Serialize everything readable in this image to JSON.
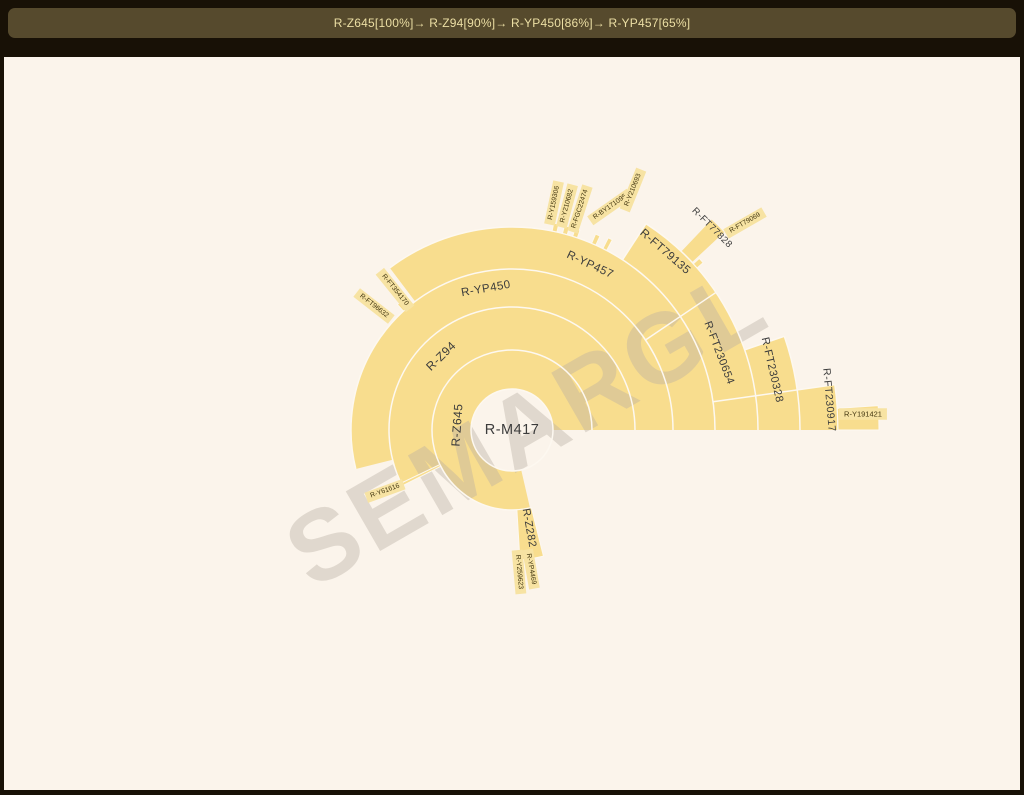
{
  "header": {
    "breadcrumb": [
      {
        "label": "R-Z645",
        "pct": "100%"
      },
      {
        "label": "R-Z94",
        "pct": "90%"
      },
      {
        "label": "R-YP450",
        "pct": "86%"
      },
      {
        "label": "R-YP457",
        "pct": "65%"
      }
    ],
    "separator": "→ "
  },
  "watermark": "SEMARGL",
  "colors": {
    "page_bg": "#181106",
    "bar_bg": "#564a2d",
    "bar_text": "#ecdfa4",
    "canvas_bg": "#fbf4eb",
    "wedge_fill": "#f8dd8e",
    "stub_box_fill": "#f7e3a3",
    "separator_stroke": "#fdf8f0",
    "label_text": "#3c3c3c",
    "stub_text": "#41350f",
    "watermark_color": "rgba(184,174,162,0.40)"
  },
  "chart_data": {
    "type": "sunburst",
    "title": "Y-DNA haplogroup subclade tree (radial sunburst)",
    "center_label": "R-M417",
    "legend_position": "none",
    "grid": false,
    "nodes": [
      {
        "name": "R-M417",
        "parent": null,
        "depth": 0
      },
      {
        "name": "R-Z645",
        "parent": "R-M417",
        "depth": 1,
        "span_deg": [
          0,
          283
        ]
      },
      {
        "name": "R-Z94",
        "parent": "R-Z645",
        "depth": 2,
        "span_deg": [
          0,
          207
        ]
      },
      {
        "name": "R-Y61616",
        "parent": "R-Z645",
        "depth": 2,
        "span_deg": [
          205.6,
          207
        ]
      },
      {
        "name": "R-Z282",
        "parent": "R-Z645",
        "depth": 2,
        "span_deg": [
          273.5,
          284
        ]
      },
      {
        "name": "R-Y259623",
        "parent": "R-Z282",
        "depth": 3,
        "span_deg": [
          271,
          274
        ]
      },
      {
        "name": "R-YP4469",
        "parent": "R-Z282",
        "depth": 3,
        "span_deg": [
          276,
          279
        ]
      },
      {
        "name": "R-YP450",
        "parent": "R-Z94",
        "depth": 3,
        "span_deg": [
          0,
          194
        ]
      },
      {
        "name": "R-YP457",
        "parent": "R-YP450",
        "depth": 4,
        "span_deg": [
          34,
          127
        ]
      },
      {
        "name": "R-FT354170",
        "parent": "R-YP450",
        "depth": 4,
        "span_deg": [
          128,
          129.4
        ]
      },
      {
        "name": "R-FT96632",
        "parent": "R-YP450",
        "depth": 4,
        "span_deg": [
          131,
          132.4
        ]
      },
      {
        "name": "R-FT230654",
        "parent": "R-YP450",
        "depth": 4,
        "span_deg": [
          0,
          34
        ]
      },
      {
        "name": "R-Y159306",
        "parent": "R-YP457",
        "depth": 5,
        "span_deg": [
          77.2,
          78.6
        ]
      },
      {
        "name": "R-Y210682",
        "parent": "R-YP457",
        "depth": 5,
        "span_deg": [
          74.2,
          75.6
        ]
      },
      {
        "name": "R-FGC22474",
        "parent": "R-YP457",
        "depth": 5,
        "span_deg": [
          71.2,
          72.6
        ]
      },
      {
        "name": "R-BY171095",
        "parent": "R-YP457",
        "depth": 5,
        "span_deg": [
          65.6,
          66.9
        ]
      },
      {
        "name": "R-Y210693",
        "parent": "R-YP457",
        "depth": 5,
        "span_deg": [
          62.2,
          63.4
        ]
      },
      {
        "name": "R-FT79135",
        "parent": "R-YP457",
        "depth": 5,
        "span_deg": [
          34,
          57
        ]
      },
      {
        "name": "R-FT77828",
        "parent": "R-FT79135",
        "depth": 6,
        "span_deg": [
          43,
          46.5
        ]
      },
      {
        "name": "R-FT79069",
        "parent": "R-FT79135",
        "depth": 6,
        "span_deg": [
          41.2,
          42.5
        ]
      },
      {
        "name": "R-FT230328",
        "parent": "R-FT230654",
        "depth": 5,
        "span_deg": [
          2.5,
          19
        ]
      },
      {
        "name": "R-FT230917",
        "parent": "R-FT230328",
        "depth": 6,
        "span_deg": [
          0,
          8
        ]
      },
      {
        "name": "R-Y191421",
        "parent": "R-FT230917",
        "depth": 7,
        "span_deg": [
          0,
          3.8
        ]
      }
    ],
    "geometry": {
      "center_px": {
        "x": 512,
        "y": 430
      },
      "inner_radius": 41,
      "ring_boundaries": [
        41,
        80,
        123,
        161,
        203,
        246,
        288,
        326,
        367
      ],
      "bands": [
        {
          "n": "R-Z645",
          "r0": 41,
          "r1": 80,
          "a0": 0,
          "a1": 283
        },
        {
          "n": "R-Z94",
          "r0": 80,
          "r1": 123,
          "a0": 0,
          "a1": 207
        },
        {
          "n": "R-YP450",
          "r0": 123,
          "r1": 161,
          "a0": 0,
          "a1": 194
        },
        {
          "n": "ring4-R-YP457-R-FT230654",
          "r0": 161,
          "r1": 203,
          "a0": 0,
          "a1": 127
        },
        {
          "n": "ring5-R-FT79135-R-FT230328",
          "r0": 203,
          "r1": 246,
          "a0": 0,
          "a1": 57
        },
        {
          "n": "ring6-R-FT230328-R-FT230917",
          "r0": 246,
          "r1": 288,
          "a0": 0,
          "a1": 19
        },
        {
          "n": "ring7-R-FT230917",
          "r0": 288,
          "r1": 326,
          "a0": 0,
          "a1": 8
        },
        {
          "n": "R-FT77828",
          "r0": 246,
          "r1": 290,
          "a0": 43,
          "a1": 46.5
        }
      ],
      "slivers": [
        {
          "n": "R-Z282",
          "r0": 80,
          "r1": 130,
          "a0": 273.5,
          "a1": 284
        },
        {
          "n": "R-Y191421",
          "r0": 326,
          "r1": 367,
          "a0": 0,
          "a1": 3.8
        },
        {
          "n": "R-Y61616",
          "r0": 80,
          "r1": 123,
          "a0": 205.6,
          "a1": 207
        },
        {
          "n": "R-FT354170",
          "r0": 161,
          "r1": 170,
          "a0": 128,
          "a1": 129.4
        },
        {
          "n": "R-FT96632",
          "r0": 161,
          "r1": 170,
          "a0": 131,
          "a1": 132.4
        },
        {
          "n": "R-Y159306",
          "r0": 203,
          "r1": 211,
          "a0": 77.2,
          "a1": 78.6
        },
        {
          "n": "R-Y210682",
          "r0": 203,
          "r1": 211,
          "a0": 74.2,
          "a1": 75.6
        },
        {
          "n": "R-FGC22474",
          "r0": 203,
          "r1": 211,
          "a0": 71.2,
          "a1": 72.6
        },
        {
          "n": "R-BY171095",
          "r0": 203,
          "r1": 213,
          "a0": 65.6,
          "a1": 66.9
        },
        {
          "n": "R-Y210693",
          "r0": 203,
          "r1": 215,
          "a0": 62.2,
          "a1": 63.4
        },
        {
          "n": "R-FT79069",
          "r0": 246,
          "r1": 254,
          "a0": 41.2,
          "a1": 42.5
        }
      ],
      "separator_arcs": [
        {
          "r": 41,
          "a0": 0,
          "a1": 360
        },
        {
          "r": 80,
          "a0": 0,
          "a1": 283
        },
        {
          "r": 123,
          "a0": 0,
          "a1": 207
        },
        {
          "r": 161,
          "a0": 0,
          "a1": 194
        },
        {
          "r": 203,
          "a0": 0,
          "a1": 127
        },
        {
          "r": 246,
          "a0": 0,
          "a1": 57
        },
        {
          "r": 288,
          "a0": 0,
          "a1": 19
        },
        {
          "r": 326,
          "a0": 0,
          "a1": 8
        }
      ],
      "separator_radials": [
        {
          "a": 34,
          "r0": 161,
          "r1": 246
        },
        {
          "a": 57,
          "r0": 203,
          "r1": 246
        },
        {
          "a": 19,
          "r0": 246,
          "r1": 288
        },
        {
          "a": 8,
          "r0": 203,
          "r1": 326
        }
      ],
      "arc_labels": [
        {
          "t": "R-M417",
          "x": 512,
          "y": 430,
          "rot": 0,
          "size": 14.5
        },
        {
          "t": "R-Z645",
          "x": 457,
          "y": 425,
          "rot": -86,
          "size": 12
        },
        {
          "t": "R-Z94",
          "x": 441,
          "y": 356,
          "rot": -44,
          "size": 12
        },
        {
          "t": "R-YP450",
          "x": 486,
          "y": 289,
          "rot": -10,
          "size": 11.5
        },
        {
          "t": "R-YP457",
          "x": 590,
          "y": 265,
          "rot": 25,
          "size": 11.5
        },
        {
          "t": "R-FT79135",
          "x": 665,
          "y": 252,
          "rot": 41,
          "size": 11.5
        },
        {
          "t": "R-FT77828",
          "x": 712,
          "y": 228,
          "rot": 45,
          "size": 9.5
        },
        {
          "t": "R-FT230654",
          "x": 719,
          "y": 353,
          "rot": 69,
          "size": 11
        },
        {
          "t": "R-FT230328",
          "x": 772,
          "y": 370,
          "rot": 77,
          "size": 11
        },
        {
          "t": "R-FT230917",
          "x": 829,
          "y": 400,
          "rot": 85,
          "size": 10.5
        },
        {
          "t": "R-Z282",
          "x": 529,
          "y": 528,
          "rot": 80,
          "size": 11
        }
      ],
      "stub_labels": [
        {
          "t": "R-Y159306",
          "x": 554,
          "y": 203,
          "rot": -78
        },
        {
          "t": "R-Y210682",
          "x": 567,
          "y": 206,
          "rot": -75
        },
        {
          "t": "R-FGC22474",
          "x": 580,
          "y": 209,
          "rot": -72
        },
        {
          "t": "R-BY171095",
          "x": 610,
          "y": 207,
          "rot": -35
        },
        {
          "t": "R-Y210693",
          "x": 633,
          "y": 190,
          "rot": -68
        },
        {
          "t": "R-FT79069",
          "x": 745,
          "y": 223,
          "rot": -30
        },
        {
          "t": "R-FT354170",
          "x": 395,
          "y": 290,
          "rot": 51
        },
        {
          "t": "R-FT96632",
          "x": 374,
          "y": 306,
          "rot": 38
        },
        {
          "t": "R-Y61616",
          "x": 385,
          "y": 491,
          "rot": -20
        },
        {
          "t": "R-Y259623",
          "x": 519,
          "y": 572,
          "rot": 85
        },
        {
          "t": "R-YP4469",
          "x": 531,
          "y": 569,
          "rot": 80
        },
        {
          "t": "R-Y191421",
          "x": 863,
          "y": 414,
          "rot": 0,
          "size": 7.5
        }
      ],
      "watermark": {
        "x": 527,
        "y": 427,
        "rot": -30,
        "size": 100,
        "spacing": 5
      }
    }
  }
}
